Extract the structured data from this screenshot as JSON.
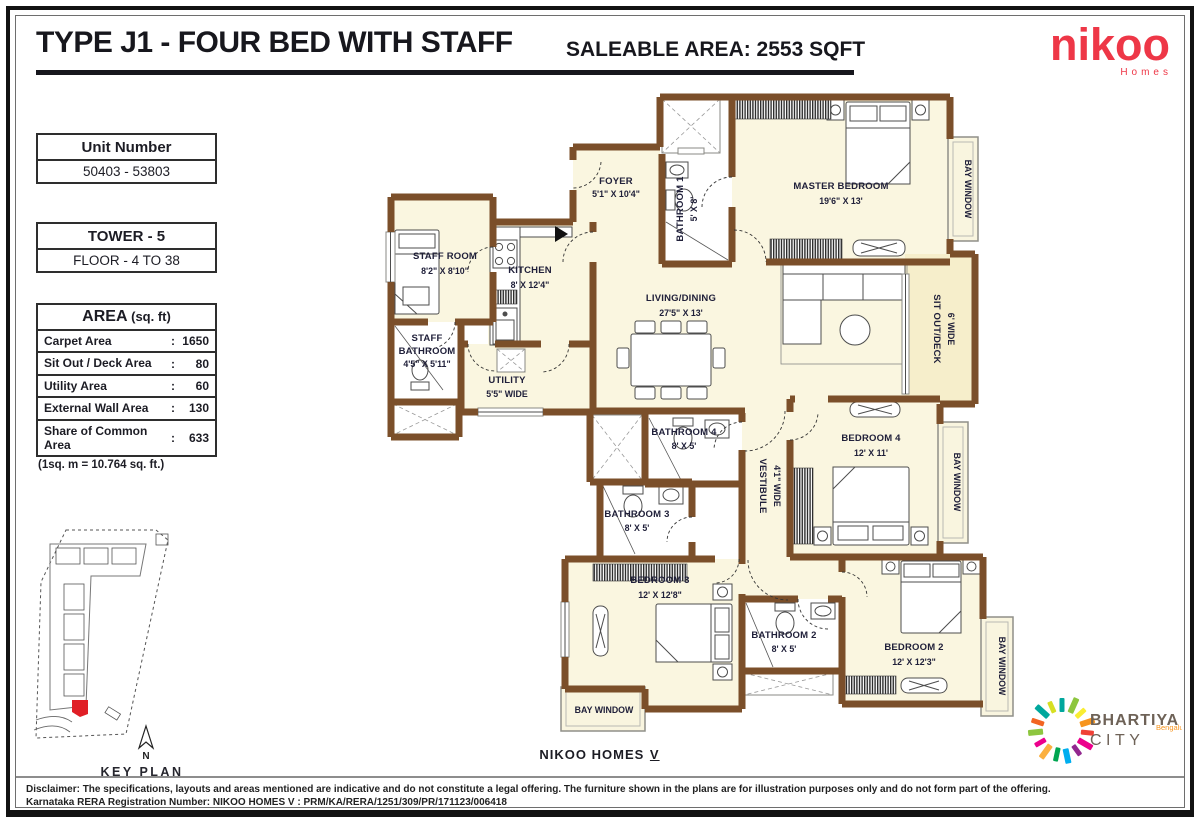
{
  "header": {
    "title": "TYPE J1 - FOUR BED WITH STAFF",
    "saleable": "SALEABLE AREA: 2553 SQFT"
  },
  "brand": {
    "nikoo_name": "nikoo",
    "nikoo_sub": "Homes",
    "nikoo_color": "#ee3747",
    "bhartiya_line1": "BHARTIYA",
    "bhartiya_line2": "CITY",
    "bhartiya_city": "Bengaluru"
  },
  "info": {
    "unit_number_label": "Unit Number",
    "unit_number_value": "50403 - 53803",
    "tower_label": "TOWER - 5",
    "floor_label": "FLOOR - 4 TO 38",
    "area_title": "AREA",
    "area_title_unit": "(sq. ft)",
    "colon": ":",
    "area_rows": [
      {
        "label": "Carpet Area",
        "value": "1650"
      },
      {
        "label": "Sit Out / Deck Area",
        "value": "80"
      },
      {
        "label": "Utility Area",
        "value": "60"
      },
      {
        "label": "External Wall Area",
        "value": "130"
      },
      {
        "label": "Share of Common Area",
        "value": "633"
      }
    ],
    "conversion_note": "(1sq. m = 10.764 sq. ft.)"
  },
  "keyplan": {
    "north_label": "N",
    "title": "KEY PLAN",
    "highlight_color": "#e01f26"
  },
  "plan": {
    "wall_color": "#7b4f2a",
    "floor_color": "#faf6e0",
    "deck_color": "#f6eecb",
    "label_color": "#20203a",
    "bay_window": "BAY WINDOW",
    "rooms": [
      {
        "name": "FOYER",
        "dim": "5'1\" X 10'4\""
      },
      {
        "name": "BATHROOM 1",
        "dim": "5' X 8'"
      },
      {
        "name": "MASTER BEDROOM",
        "dim": "19'6\" X 13'"
      },
      {
        "name": "STAFF ROOM",
        "dim": "8'2\" X 8'10\""
      },
      {
        "name": "KITCHEN",
        "dim": "8' X 12'4\""
      },
      {
        "name": "STAFF",
        "name2": "BATHROOM",
        "dim": "4'5\" X 5'11\""
      },
      {
        "name": "UTILITY",
        "dim": "5'5\" WIDE"
      },
      {
        "name": "LIVING/DINING",
        "dim": "27'5\" X 13'"
      },
      {
        "name": "SIT OUT/DECK",
        "dim": "6' WIDE"
      },
      {
        "name": "BATHROOM 4",
        "dim": "8' X 5'"
      },
      {
        "name": "VESTIBULE",
        "dim": "4'1\" WIDE"
      },
      {
        "name": "BEDROOM 4",
        "dim": "12' X 11'"
      },
      {
        "name": "BATHROOM 3",
        "dim": "8' X 5'"
      },
      {
        "name": "BEDROOM 3",
        "dim": "12' X 12'8\""
      },
      {
        "name": "BATHROOM 2",
        "dim": "8' X 5'"
      },
      {
        "name": "BEDROOM 2",
        "dim": "12' X 12'3\""
      }
    ]
  },
  "footer": {
    "center_main": "NIKOO HOMES",
    "center_roman": "V",
    "disclaimer_label": "Disclaimer:",
    "disclaimer_text": "The specifications, layouts and areas mentioned are indicative and do not constitute a legal offering. The furniture shown in the plans are for illustration purposes only and do not form part of the offering.",
    "rera_label": "Karnataka RERA Registration Number:",
    "rera_value": "NIKOO HOMES V : PRM/KA/RERA/1251/309/PR/171123/006418"
  }
}
